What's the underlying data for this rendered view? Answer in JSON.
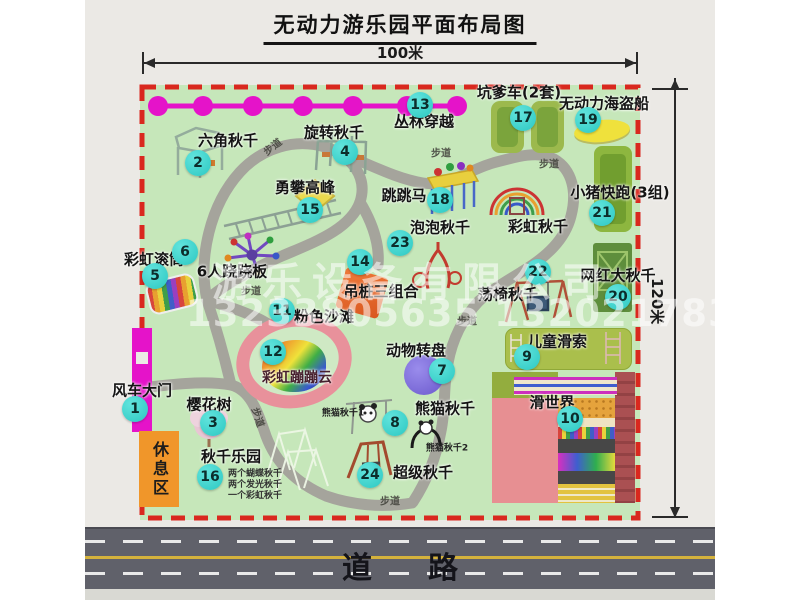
{
  "title": "无动力游乐园平面布局图",
  "dimensions": {
    "width": "100米",
    "height": "120米"
  },
  "road_label": "道路",
  "watermark": {
    "company": "游乐设备有限公司",
    "phone": "13233805635 13202178333"
  },
  "rest_area": "休息区",
  "path_label": "步道",
  "extra_labels": {
    "rainbow_swing": "彩虹秋千",
    "panda_swing_1": "熊猫秋千1",
    "panda_swing_2": "熊猫秋千2"
  },
  "swing_park_notes": [
    "两个蝴蝶秋千",
    "两个发光秋千",
    "一个彩虹秋千"
  ],
  "attractions": [
    {
      "num": "1",
      "label": "风车大门"
    },
    {
      "num": "2",
      "label": "六角秋千"
    },
    {
      "num": "3",
      "label": "樱花树"
    },
    {
      "num": "4",
      "label": "旋转秋千"
    },
    {
      "num": "5",
      "label": "彩虹滚筒"
    },
    {
      "num": "6",
      "label": "6人跷跷板"
    },
    {
      "num": "7",
      "label": "动物转盘"
    },
    {
      "num": "8",
      "label": "熊猫秋千"
    },
    {
      "num": "9",
      "label": "儿童滑索"
    },
    {
      "num": "10",
      "label": "滑世界"
    },
    {
      "num": "11",
      "label": "粉色沙滩"
    },
    {
      "num": "12",
      "label": "彩虹蹦蹦云"
    },
    {
      "num": "13",
      "label": "丛林穿越"
    },
    {
      "num": "14",
      "label": "吊桩三组合"
    },
    {
      "num": "15",
      "label": "勇攀高峰"
    },
    {
      "num": "16",
      "label": "秋千乐园"
    },
    {
      "num": "17",
      "label": "坑爹车(2套)"
    },
    {
      "num": "18",
      "label": "跳跳马"
    },
    {
      "num": "19",
      "label": "无动力海盗船"
    },
    {
      "num": "20",
      "label": "网红大秋千"
    },
    {
      "num": "21",
      "label": "小猪快跑(3组)"
    },
    {
      "num": "22",
      "label": "荡椅秋千"
    },
    {
      "num": "23",
      "label": "泡泡秋千"
    },
    {
      "num": "24",
      "label": "超级秋千"
    }
  ],
  "colors": {
    "badge": "#3ed3cd",
    "map_border": "#d9281e",
    "map_bg": "#c6e7ba",
    "chain": "#e513c9"
  }
}
